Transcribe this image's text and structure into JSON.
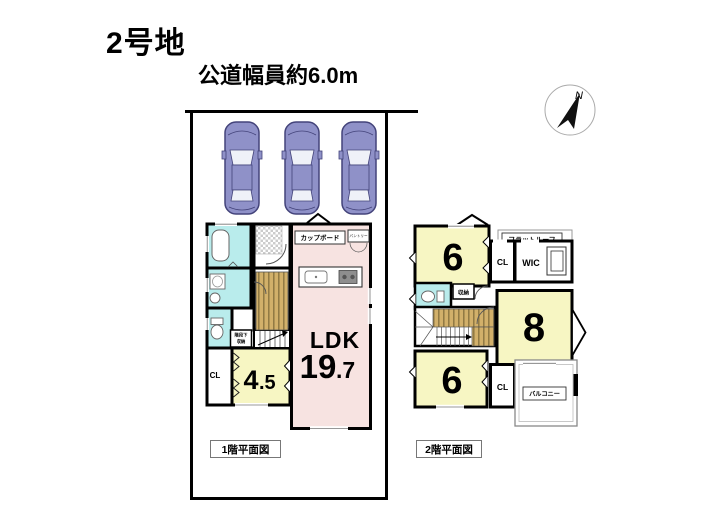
{
  "header": {
    "title": "2号地",
    "road_label": "公道幅員約6.0m"
  },
  "compass": {
    "north": "N"
  },
  "parking": {
    "car_count": 3
  },
  "floor1": {
    "caption": "1階平面図",
    "ldk_label": "LDK",
    "ldk_size_main": "19",
    "ldk_size_frac": ".7",
    "tatami_main": "4",
    "tatami_frac": ".5",
    "closet": "CL",
    "cupboard": "カップボード",
    "pantry": "パントリー",
    "under_stair_line1": "階段下",
    "under_stair_line2": "収納"
  },
  "floor2": {
    "caption": "2階平面図",
    "room6_top": "6",
    "room6_bottom": "6",
    "room8": "8",
    "closet_top": "CL",
    "closet_bottom": "CL",
    "wic": "WIC",
    "storage": "収納",
    "flat_roof": "フラットルーフ",
    "balcony": "バルコニー"
  },
  "colors": {
    "wall": "#000000",
    "room_yellow": "#F7F6C3",
    "ldk_pink": "#F7E3E1",
    "wet_area_cyan": "#B9ECEC",
    "stairs_tan": "#D2B06A",
    "car_body": "#8F91C8"
  }
}
